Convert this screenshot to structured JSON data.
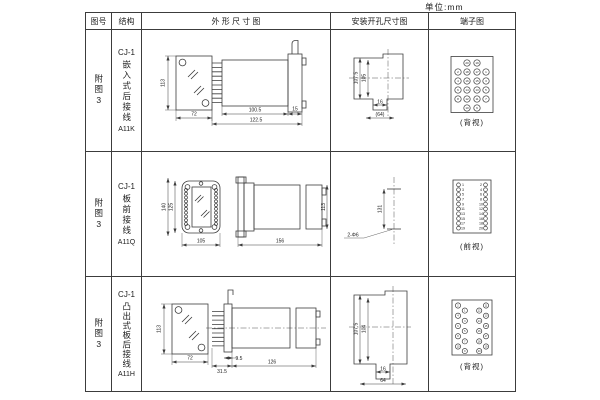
{
  "page": {
    "unit_label": "单位:mm"
  },
  "header": {
    "figure": "图号",
    "structure": "结构",
    "outline": "外 形 尺 寸 图",
    "mounting": "安装开孔尺寸图",
    "terminal": "端子图"
  },
  "rows": [
    {
      "figure": "附图3",
      "structure": {
        "model": "CJ-1",
        "desc": "嵌入式后接线",
        "code": "A11K"
      },
      "outline_dims": {
        "front_height": "113",
        "front_width": "72",
        "body_length": "100.5",
        "overall_length": "122.5",
        "flange_depth": "15"
      },
      "mounting_dims": {
        "height_outer": "107.5",
        "height_inner": "105",
        "slot_width": "16",
        "overall_width": "(64)"
      },
      "terminal": {
        "caption": "(背视)",
        "numbers": [
          "20",
          "19",
          "2",
          "18",
          "17",
          "1",
          "4",
          "16",
          "15",
          "3",
          "6",
          "14",
          "13",
          "5",
          "8",
          "12",
          "11",
          "7",
          "10",
          "9"
        ]
      }
    },
    {
      "figure": "附图3",
      "structure": {
        "model": "CJ-1",
        "desc": "板前接线",
        "code": "A11Q"
      },
      "outline_dims": {
        "front_height_outer": "140",
        "front_height_inner": "125",
        "front_width": "105",
        "side_length": "156",
        "side_height": "113"
      },
      "mounting_dims": {
        "hole_distance": "131",
        "hole_spec": "2-Φ6"
      },
      "terminal": {
        "caption": "(前视)",
        "left_numbers": [
          "1",
          "3",
          "5",
          "7",
          "9",
          "11",
          "13",
          "15",
          "17",
          "19"
        ],
        "right_numbers": [
          "2",
          "4",
          "6",
          "8",
          "10",
          "12",
          "14",
          "16",
          "18",
          "20"
        ]
      }
    },
    {
      "figure": "附图3",
      "structure": {
        "model": "CJ-1",
        "desc": "凸出式板后接线",
        "code": "A11H"
      },
      "outline_dims": {
        "front_height": "113",
        "front_width": "72",
        "pin_depth": "31.5",
        "step_depth": "9.5",
        "body_length": "126"
      },
      "mounting_dims": {
        "height_outer": "107.5",
        "height_inner": "104",
        "slot_width": "16",
        "overall_width": "64"
      },
      "terminal": {
        "caption": "(背视)",
        "numbers": [
          "2",
          "1",
          "4",
          "3",
          "6",
          "5",
          "8",
          "7",
          "10",
          "9",
          "12",
          "11",
          "14",
          "13",
          "16",
          "15",
          "18",
          "17",
          "20",
          "19"
        ]
      }
    }
  ]
}
